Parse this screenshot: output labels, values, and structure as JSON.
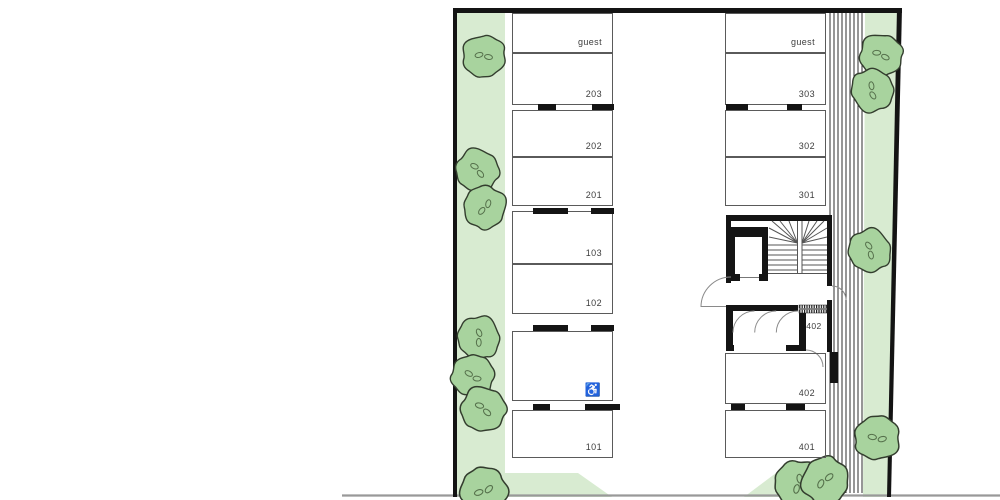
{
  "scene": {
    "type": "architectural-floor-plan",
    "description": "Parking level site plan with numbered stalls, stair/elevator core, landscaping strips with trees and hatched slope"
  },
  "colors": {
    "background": "#ffffff",
    "landscape_strip": "#d8ebd1",
    "tree_fill": "#a8d39e",
    "tree_outline": "#333d2e",
    "wall_black": "#141414",
    "thin_line": "#5a5a5a",
    "door_arc": "#8a8a8a",
    "street_line": "#999999",
    "label_text": "#3d3d3d"
  },
  "left_column": {
    "spaces": [
      {
        "label": "guest"
      },
      {
        "label": "203"
      },
      {
        "label": "202"
      },
      {
        "label": "201"
      },
      {
        "label": "103"
      },
      {
        "label": "102"
      },
      {
        "label": "",
        "accessible": true
      },
      {
        "label": "101"
      }
    ]
  },
  "right_column": {
    "upper_spaces": [
      {
        "label": "guest"
      },
      {
        "label": "303"
      },
      {
        "label": "302"
      },
      {
        "label": "301"
      }
    ],
    "lower_spaces": [
      {
        "label": "402"
      },
      {
        "label": "401"
      }
    ]
  },
  "storage_room": {
    "label": "402"
  },
  "icons": {
    "wheelchair": "♿"
  }
}
